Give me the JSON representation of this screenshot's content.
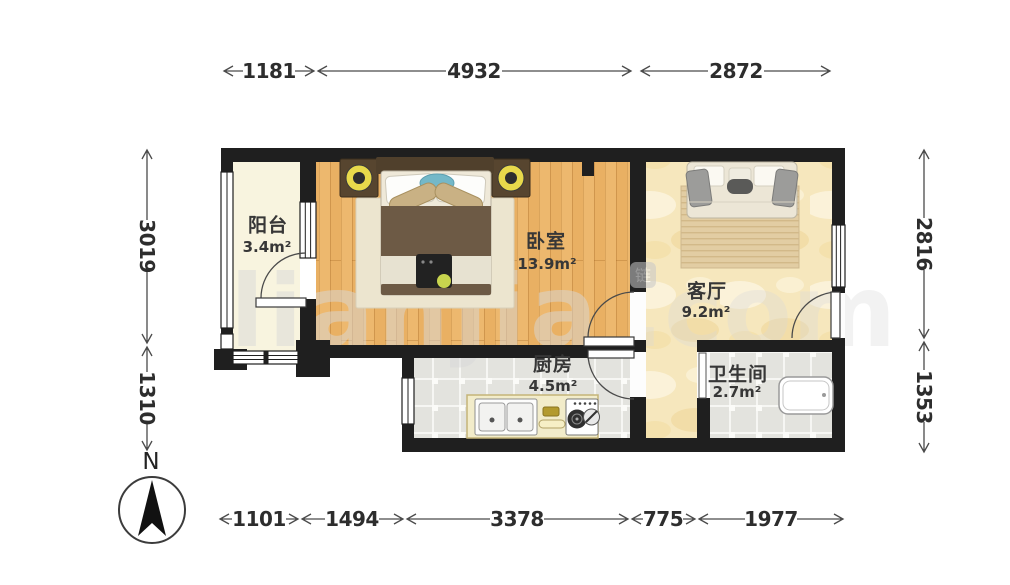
{
  "plan": {
    "compass": {
      "label": "N"
    },
    "watermark": {
      "text": "lianjia",
      "suffix": ".com",
      "logo_char": "链"
    },
    "rooms": [
      {
        "id": "balcony",
        "name": "阳台",
        "area": "3.4m²"
      },
      {
        "id": "bedroom",
        "name": "卧室",
        "area": "13.9m²"
      },
      {
        "id": "living-room",
        "name": "客厅",
        "area": "9.2m²"
      },
      {
        "id": "kitchen",
        "name": "厨房",
        "area": "4.5m²"
      },
      {
        "id": "bathroom",
        "name": "卫生间",
        "area": "2.7m²"
      }
    ],
    "dimensions_mm": {
      "top": [
        "1181",
        "4932",
        "2872"
      ],
      "bottom": [
        "1101",
        "1494",
        "3378",
        "775",
        "1977"
      ],
      "left": [
        "3019",
        "1310"
      ],
      "right": [
        "2816",
        "1353"
      ]
    },
    "colors": {
      "wall": "#1f1f1f",
      "wood_floor": "#edb86e",
      "marble_floor": "#f6e7bd",
      "tile_floor": "#e3e3de",
      "balcony_floor": "#f8f4df",
      "dimension_text": "#2d2d2d",
      "label_text": "#373737",
      "watermark": "#d9d9d9"
    }
  }
}
